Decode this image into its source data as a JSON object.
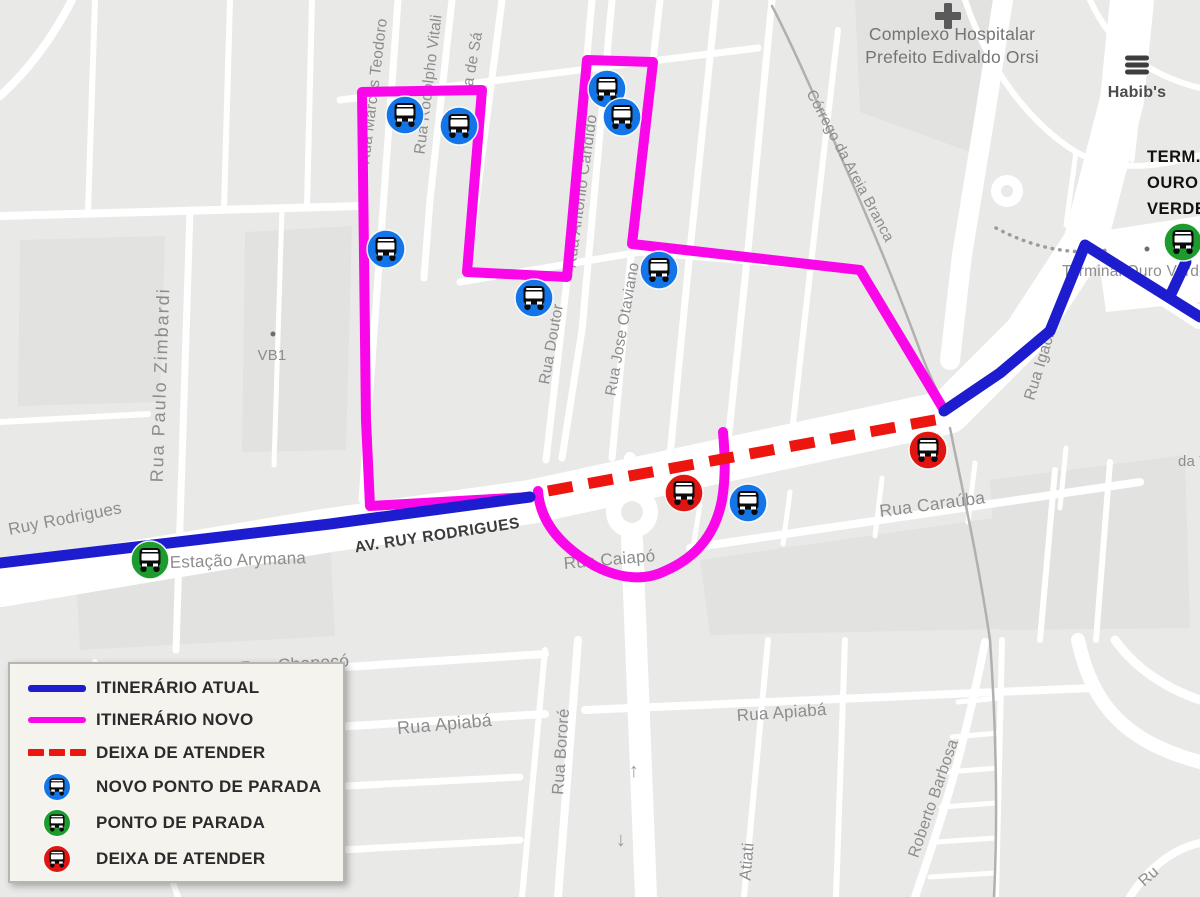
{
  "page": {
    "background": "#e9e9e7",
    "road_color": "#ffffff",
    "block_color": "#e2e2e0"
  },
  "legend": {
    "items": [
      {
        "type": "line",
        "style": "solid",
        "color": "#1d1cce",
        "label": "ITINERÁRIO ATUAL"
      },
      {
        "type": "line",
        "style": "solid",
        "color": "#f907e8",
        "label": "ITINERÁRIO NOVO"
      },
      {
        "type": "line",
        "style": "dashed",
        "color": "#ed1510",
        "label": "DEIXA DE ATENDER"
      },
      {
        "type": "bus",
        "color": "#1375e8",
        "label": "NOVO PONTO DE PARADA"
      },
      {
        "type": "bus",
        "color": "#1d9b2e",
        "label": "PONTO DE PARADA"
      },
      {
        "type": "bus",
        "color": "#e01511",
        "label": "DEIXA DE ATENDER"
      }
    ]
  },
  "map": {
    "routes": {
      "current": {
        "name": "itinerario-atual",
        "color": "#1d1cce",
        "width": 11,
        "paths": [
          "M 0,563 L 330,524 L 530,497",
          "M 944,411 L 1000,373 L 1050,331 L 1085,245 L 1200,317",
          "M 1170,296 L 1186,262"
        ]
      },
      "new": {
        "name": "itinerario-novo",
        "color": "#f907e8",
        "width": 10,
        "paths": [
          "M 530,497 L 370,506 L 366,420 L 362,92 L 482,90 L 467,272 L 567,277 L 587,60 L 653,62 L 632,244 L 860,270 L 944,410",
          "M 538,491 C 540,521 560,546 595,566 C 620,579 645,581 665,571 C 695,558 715,536 722,500 C 726,476 725,455 723,432"
        ]
      },
      "removed": {
        "name": "deixa-de-atender",
        "color": "#ed1510",
        "width": 11,
        "dash": "25 16",
        "paths": [
          "M 548,491 L 940,419"
        ]
      }
    },
    "stops": {
      "new": {
        "color": "#1375e8",
        "points": [
          [
            405,
            115
          ],
          [
            459,
            126
          ],
          [
            386,
            249
          ],
          [
            534,
            298
          ],
          [
            607,
            89
          ],
          [
            622,
            117
          ],
          [
            659,
            270
          ],
          [
            748,
            503
          ]
        ]
      },
      "current": {
        "color": "#1d9b2e",
        "points": [
          [
            150,
            560
          ],
          [
            1183,
            242
          ]
        ]
      },
      "removed": {
        "color": "#e01511",
        "points": [
          [
            684,
            493
          ],
          [
            928,
            450
          ]
        ]
      }
    },
    "street_labels": [
      {
        "text": "Rua Marcos Teodoro",
        "x": 378,
        "y": 92,
        "r": -83,
        "s": 15.5
      },
      {
        "text": "Rua Rodolpho Vitali",
        "x": 433,
        "y": 85,
        "r": -83,
        "s": 15.5
      },
      {
        "text": "ta de Sá",
        "x": 477,
        "y": 62,
        "r": -80,
        "s": 15.5
      },
      {
        "text": "Rua Antônio Cândido",
        "x": 586,
        "y": 192,
        "r": -82,
        "s": 16
      },
      {
        "text": "Rua Doutor",
        "x": 556,
        "y": 345,
        "r": -80,
        "s": 15.5
      },
      {
        "text": "Rua Jose Otaviano",
        "x": 627,
        "y": 330,
        "r": -80,
        "s": 15.5
      },
      {
        "text": "Rua Paulo Zimbardi",
        "x": 166,
        "y": 385,
        "r": -88,
        "s": 18,
        "ls": 2
      },
      {
        "text": "VB1",
        "x": 272,
        "y": 360,
        "r": 0,
        "s": 15
      },
      {
        "text": "Ruy Rodrigues",
        "x": 66,
        "y": 524,
        "r": -11,
        "s": 17
      },
      {
        "text": "AV. RUY RODRIGUES",
        "x": 438,
        "y": 540,
        "r": -8.5,
        "s": 15.5,
        "fill": "#3c3c3c",
        "bold": true,
        "ls": 0.5
      },
      {
        "text": "Estação Arymana",
        "x": 170,
        "y": 568,
        "r": -2,
        "s": 17,
        "anchor": "start"
      },
      {
        "text": "Rua Caraúba",
        "x": 933,
        "y": 510,
        "r": -7.5,
        "s": 17.5
      },
      {
        "text": "Rua Caiapó",
        "x": 610,
        "y": 565,
        "r": -5,
        "s": 17
      },
      {
        "text": "Rua Chapecó",
        "x": 295,
        "y": 670,
        "r": -4,
        "s": 17.5
      },
      {
        "text": "Rua Apiabá",
        "x": 445,
        "y": 730,
        "r": -5,
        "s": 18
      },
      {
        "text": "Rua Apiabá",
        "x": 782,
        "y": 718,
        "r": -4,
        "s": 17
      },
      {
        "text": "Rua Batuiritê",
        "x": 185,
        "y": 796,
        "r": -3,
        "s": 17
      },
      {
        "text": "Rua Abunã",
        "x": 235,
        "y": 856,
        "r": -2,
        "s": 17.5
      },
      {
        "text": "Rua Bororé",
        "x": 566,
        "y": 752,
        "r": -86,
        "s": 16.5
      },
      {
        "text": "Atiati",
        "x": 752,
        "y": 862,
        "r": -85,
        "s": 16.5
      },
      {
        "text": "Roberto Barbosa",
        "x": 938,
        "y": 800,
        "r": -71,
        "s": 16
      },
      {
        "text": "Ru",
        "x": 1152,
        "y": 880,
        "r": -42,
        "s": 16
      },
      {
        "text": "Rua Igaci",
        "x": 1044,
        "y": 368,
        "r": -73,
        "s": 16
      },
      {
        "text": "da T",
        "x": 1178,
        "y": 466,
        "r": 0,
        "s": 15,
        "anchor": "start"
      },
      {
        "text": "Córrego da Areia Branca",
        "x": 846,
        "y": 168,
        "r": 62,
        "s": 15
      },
      {
        "text": "Terminal Ouro Verde",
        "x": 1062,
        "y": 276,
        "r": 0,
        "s": 15.5,
        "anchor": "start"
      }
    ],
    "poi_labels": [
      {
        "text": "Complexo Hospitalar",
        "x": 952,
        "y": 40,
        "s": 17.5,
        "fill": "#757575",
        "w": "500"
      },
      {
        "text": "Prefeito Edivaldo Orsi",
        "x": 952,
        "y": 63,
        "s": 17.5,
        "fill": "#757575",
        "w": "500"
      },
      {
        "text": "Habib's",
        "x": 1137,
        "y": 97,
        "s": 16,
        "fill": "#4c4c4c",
        "w": "bold"
      },
      {
        "text": "TERM.",
        "x": 1147,
        "y": 162,
        "s": 16.5,
        "fill": "#121212",
        "w": "bold",
        "anchor": "start",
        "ls": 0.5
      },
      {
        "text": "OURO",
        "x": 1147,
        "y": 188,
        "s": 16.5,
        "fill": "#121212",
        "w": "bold",
        "anchor": "start",
        "ls": 0.5
      },
      {
        "text": "VERDE",
        "x": 1147,
        "y": 214,
        "s": 16.5,
        "fill": "#121212",
        "w": "bold",
        "anchor": "start",
        "ls": 0.5
      }
    ],
    "arrows": [
      {
        "glyph": "↑",
        "x": 634,
        "y": 777,
        "s": 20
      },
      {
        "glyph": "↓",
        "x": 621,
        "y": 846,
        "s": 20
      },
      {
        "glyph": "←",
        "x": 956,
        "y": 402,
        "s": 14,
        "r": 22
      }
    ],
    "poi_dots": [
      [
        273,
        334
      ],
      [
        1147,
        249
      ]
    ],
    "hospital_cross": {
      "x": 948,
      "y": 16,
      "color": "#5a5a5a"
    },
    "burger_icon": {
      "x": 1137,
      "y": 65,
      "color": "#3e3e3e"
    },
    "stream": {
      "color": "#b0b0ae",
      "width": 2.5,
      "paths": [
        "M 772,6 C 796,52 824,118 858,196 C 884,256 906,312 922,356 C 932,382 940,397 946,408",
        "M 950,428 C 962,488 978,558 990,640 C 996,726 998,812 994,897"
      ]
    },
    "dotted_paths": [
      {
        "d": "M 996,228 Q 1052,258 1108,250"
      }
    ],
    "roundabouts": [
      {
        "x": 632,
        "y": 512,
        "r": 26,
        "ir": 11
      },
      {
        "x": 1007,
        "y": 191,
        "r": 16,
        "ir": 6
      }
    ],
    "plaza": "1095,232 1200,216 1200,302 1106,312",
    "blocks": [
      "M 855,0 L 998,0 L 970,152 L 860,112 Z",
      "M 20,240 L 165,236 L 160,402 L 18,406 Z",
      "M 245,232 L 352,226 L 346,450 L 242,452 Z",
      "M 75,560 L 330,540 L 335,636 L 80,650 Z",
      "M 700,560 L 1035,512 L 1045,628 L 710,635 Z",
      "M 990,480 L 1185,455 L 1190,628 L 1000,630 Z"
    ],
    "roads": [
      {
        "d": "M 0,585 L 330,530 L 530,502 L 948,412 L 1025,335 L 1085,243 L 1122,100 L 1132,0",
        "w": 44
      },
      {
        "d": "M 1085,243 L 1200,318",
        "w": 22
      },
      {
        "d": "M 1003,0 L 985,115 L 962,255 L 950,360",
        "w": 20
      },
      {
        "d": "M 0,216 L 360,206",
        "w": 8
      },
      {
        "d": "M 0,96 Q 42,58 72,0",
        "w": 8
      },
      {
        "d": "M 95,0 L 88,212",
        "w": 6
      },
      {
        "d": "M 230,0 L 224,208",
        "w": 6
      },
      {
        "d": "M 312,0 L 307,206",
        "w": 6
      },
      {
        "d": "M 190,210 L 176,650",
        "w": 7
      },
      {
        "d": "M 0,422 L 148,414",
        "w": 6
      },
      {
        "d": "M 282,208 L 274,465",
        "w": 5
      },
      {
        "d": "M 398,0 L 362,500",
        "w": 7
      },
      {
        "d": "M 452,0 L 430,200 L 424,278",
        "w": 7
      },
      {
        "d": "M 502,0 L 467,272",
        "w": 7
      },
      {
        "d": "M 612,0 L 582,330 L 562,458",
        "w": 7
      },
      {
        "d": "M 592,0 L 567,280 L 546,460",
        "w": 7
      },
      {
        "d": "M 660,0 L 632,245 L 612,458",
        "w": 7
      },
      {
        "d": "M 716,0 L 690,250 L 670,456",
        "w": 7
      },
      {
        "d": "M 772,0 L 748,250 L 727,452",
        "w": 7
      },
      {
        "d": "M 838,30 L 812,255 L 790,450",
        "w": 6
      },
      {
        "d": "M 340,100 L 660,60 L 758,48",
        "w": 7
      },
      {
        "d": "M 460,282 L 640,252 L 860,270",
        "w": 7
      },
      {
        "d": "M 860,270 L 944,408",
        "w": 7
      },
      {
        "d": "M 690,548 L 1140,482",
        "w": 8
      },
      {
        "d": "M 700,505 L 693,548",
        "w": 5
      },
      {
        "d": "M 790,492 L 783,544",
        "w": 5
      },
      {
        "d": "M 882,478 L 875,536",
        "w": 5
      },
      {
        "d": "M 975,463 L 968,522",
        "w": 5
      },
      {
        "d": "M 1066,448 L 1060,508",
        "w": 5
      },
      {
        "d": "M 1055,470 L 1040,640",
        "w": 6
      },
      {
        "d": "M 1110,462 L 1096,640",
        "w": 6
      },
      {
        "d": "M 632,540 L 646,897",
        "w": 22
      },
      {
        "d": "M 632,486 L 630,458",
        "w": 12
      },
      {
        "d": "M 538,491 C 540,521 560,546 595,566 C 620,579 645,581 665,571 C 695,558 715,536 722,500 C 726,476 725,455 723,432",
        "w": 8
      },
      {
        "d": "M 85,684 L 545,654",
        "w": 8
      },
      {
        "d": "M 60,744 L 545,714",
        "w": 8
      },
      {
        "d": "M 585,710 L 1090,688",
        "w": 8
      },
      {
        "d": "M 40,802 L 520,777",
        "w": 7
      },
      {
        "d": "M 95,864 L 520,840",
        "w": 7
      },
      {
        "d": "M 545,650 L 522,897",
        "w": 6
      },
      {
        "d": "M 95,662 L 178,897",
        "w": 6
      },
      {
        "d": "M 578,640 L 558,897",
        "w": 8
      },
      {
        "d": "M 768,640 L 744,897",
        "w": 6
      },
      {
        "d": "M 845,640 L 836,897",
        "w": 6
      },
      {
        "d": "M 985,642 C 962,760 938,830 915,897",
        "w": 8
      },
      {
        "d": "M 1002,640 L 996,897",
        "w": 6
      },
      {
        "d": "M 958,702 L 1000,698",
        "w": 5
      },
      {
        "d": "M 952,737 L 999,733",
        "w": 5
      },
      {
        "d": "M 947,772 L 998,768",
        "w": 5
      },
      {
        "d": "M 941,807 L 997,803",
        "w": 5
      },
      {
        "d": "M 936,842 L 996,838",
        "w": 5
      },
      {
        "d": "M 930,877 L 995,873",
        "w": 5
      },
      {
        "d": "M 1078,640 C 1092,705 1125,742 1200,762",
        "w": 14
      },
      {
        "d": "M 1115,640 C 1135,668 1165,688 1200,700",
        "w": 9
      },
      {
        "d": "M 1130,897 C 1152,862 1180,847 1200,843",
        "w": 8
      },
      {
        "d": "M 965,0 C 988,68 1028,122 1076,152",
        "w": 6
      },
      {
        "d": "M 1076,152 C 1112,172 1156,168 1200,155",
        "w": 6
      },
      {
        "d": "M 1076,152 L 1066,225",
        "w": 5
      },
      {
        "d": "M 1090,0 C 1112,48 1148,75 1200,88",
        "w": 6
      },
      {
        "d": "M 1140,88 L 1132,160",
        "w": 5
      }
    ]
  }
}
